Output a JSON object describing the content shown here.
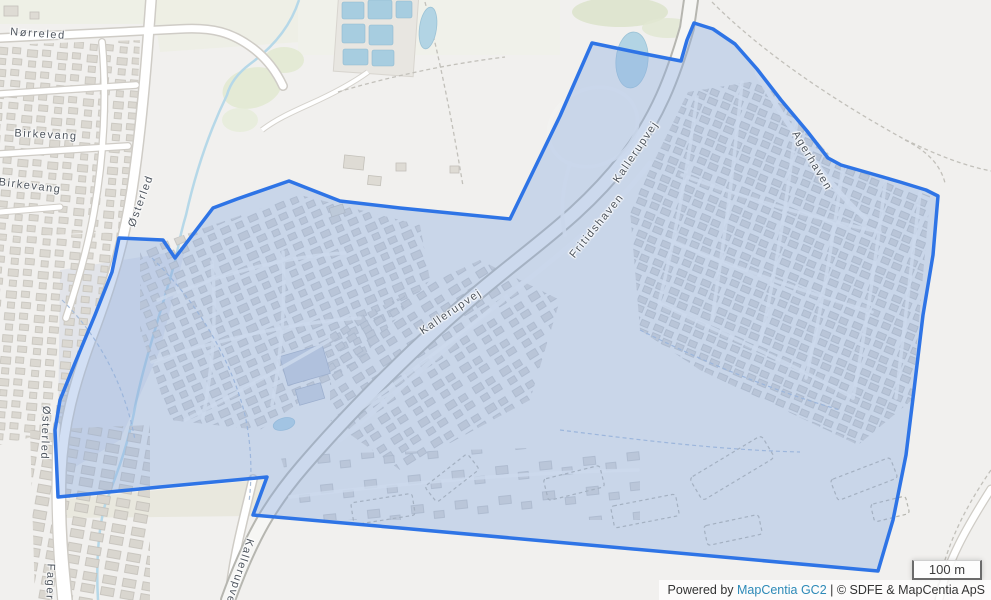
{
  "map": {
    "street_labels": [
      {
        "text": "Nørreled",
        "x": 38,
        "y": 34,
        "rotation": 4
      },
      {
        "text": "Birkevang",
        "x": 46,
        "y": 135,
        "rotation": 3
      },
      {
        "text": "Birkevang",
        "x": 30,
        "y": 186,
        "rotation": 7
      },
      {
        "text": "Østerled",
        "x": 141,
        "y": 201,
        "rotation": -70
      },
      {
        "text": "Østerled",
        "x": 45,
        "y": 433,
        "rotation": 92
      },
      {
        "text": "Fager",
        "x": 50,
        "y": 582,
        "rotation": 92
      },
      {
        "text": "Kallerupvej",
        "x": 451,
        "y": 312,
        "rotation": -34
      },
      {
        "text": "Kallerupvej",
        "x": 636,
        "y": 152,
        "rotation": -56
      },
      {
        "text": "Kallerupvej",
        "x": 239,
        "y": 573,
        "rotation": 108
      },
      {
        "text": "Fritidshaven",
        "x": 597,
        "y": 226,
        "rotation": -51
      },
      {
        "text": "Agerhaven",
        "x": 812,
        "y": 161,
        "rotation": 59
      }
    ],
    "selection_polygon": {
      "points": "119,238 163,240 175,258 213,208 237,199 289,181 340,201 400,208 510,219 560,116 592,43 640,53 681,61 687,40 694,23 713,29 735,44 757,69 781,100 807,131 828,158 841,165 869,173 900,182 926,190 938,196 933,255 923,315 914,390 906,455 893,520 878,571 600,546 400,528 253,515 267,477 160,487 58,497 55,430 60,400 75,363 95,315 112,272",
      "stroke_color": "#2e74e6",
      "fill_color": "rgba(138,170,226,0.38)",
      "stroke_width": 3.5
    },
    "scale_control": {
      "label": "100 m"
    },
    "attribution": {
      "prefix": "Powered by ",
      "link_label": "MapCentia GC2",
      "suffix": " | © SDFE & MapCentia ApS",
      "link_color": "#2d8ab8"
    }
  }
}
